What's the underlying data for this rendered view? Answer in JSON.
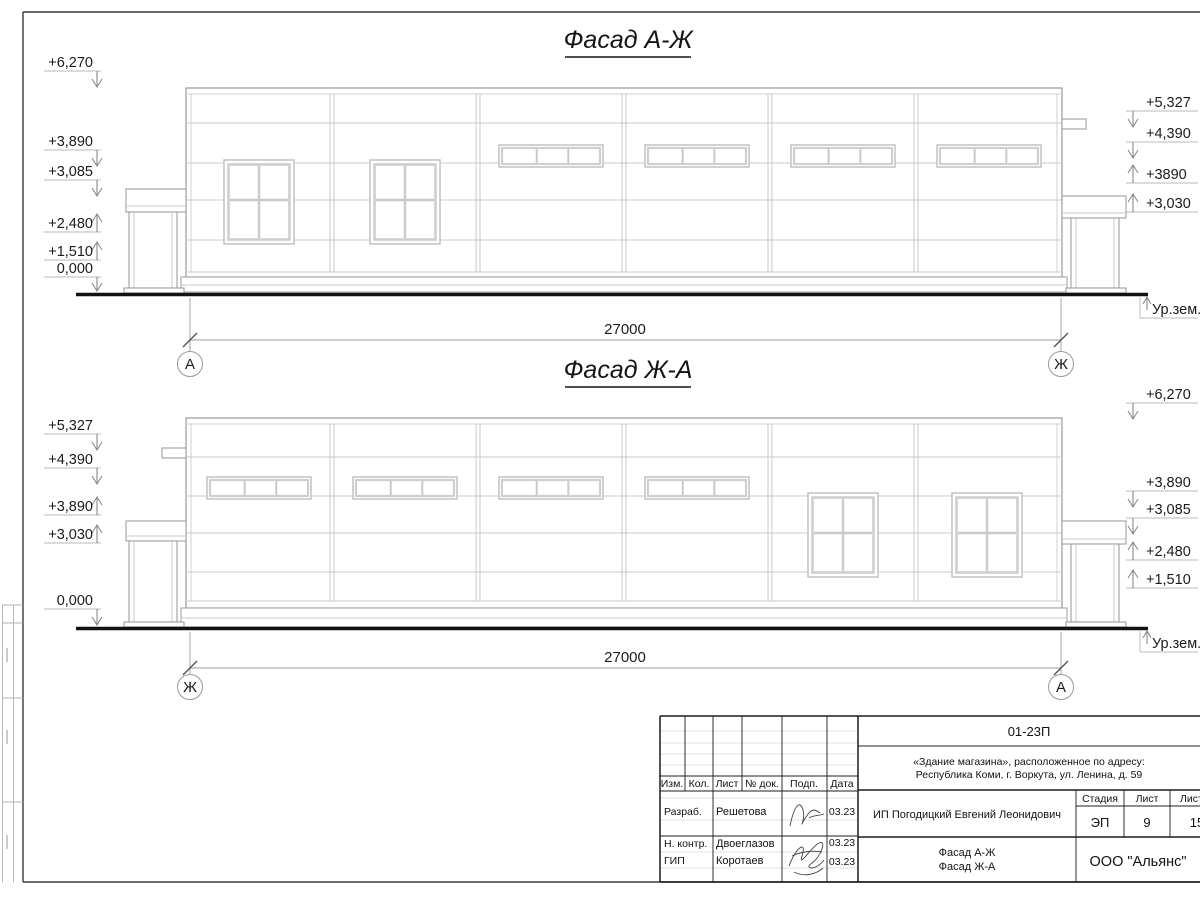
{
  "f1": {
    "title": "Фасад А-Ж",
    "dim": "27000",
    "axis_left": "А",
    "axis_right": "Ж",
    "marks_left": [
      "+6,270",
      "+3,890",
      "+3,085",
      "+2,480",
      "+1,510",
      "0,000"
    ],
    "marks_right": [
      "+5,327",
      "+4,390",
      "+3890",
      "+3,030"
    ],
    "ground_label": "Ур.зем."
  },
  "f2": {
    "title": "Фасад Ж-А",
    "dim": "27000",
    "axis_left": "Ж",
    "axis_right": "А",
    "marks_left": [
      "+5,327",
      "+4,390",
      "+3,890",
      "+3,030",
      "0,000"
    ],
    "marks_right": [
      "+6,270",
      "+3,890",
      "+3,085",
      "+2,480",
      "+1,510"
    ],
    "ground_label": "Ур.зем."
  },
  "stamp": {
    "code": "01-23П",
    "object_line1": "«Здание магазина», расположенное по адресу:",
    "object_line2": "Республика Коми, г. Воркута, ул. Ленина, д. 59",
    "client": "ИП Погодицкий Евгений Леонидович",
    "headers": {
      "izm": "Изм.",
      "kol": "Кол.",
      "list": "Лист",
      "ndok": "№ док.",
      "podp": "Подп.",
      "data": "Дата"
    },
    "rows": [
      {
        "role": "Разраб.",
        "name": "Решетова",
        "date": "03.23"
      },
      {
        "role": "Н. контр.",
        "name": "Двоеглазов",
        "date": "03.23"
      },
      {
        "role": "ГИП",
        "name": "Коротаев",
        "date": "03.23"
      }
    ],
    "stage_header": "Стадия",
    "list_header": "Лист",
    "listov_header": "Листов",
    "stage": "ЭП",
    "list": "9",
    "listov": "15",
    "sheet_title1": "Фасад А-Ж",
    "sheet_title2": "Фасад Ж-А",
    "org": "ООО \"Альянс\""
  }
}
